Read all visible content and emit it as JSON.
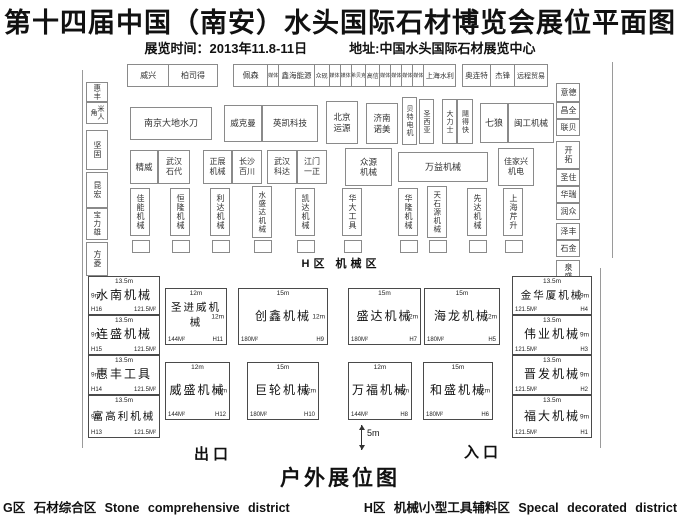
{
  "header": {
    "title": "第十四届中国（南安）水头国际石材博览会展位平面图",
    "time": "展览时间：2013年11.8-11日",
    "address": "地址:中国水头国际石材展览中心"
  },
  "plan": {
    "hall_label": "H区 机械区",
    "top_row": [
      {
        "label": "威兴",
        "w": 44,
        "fs": 8
      },
      {
        "label": "柏司得",
        "w": 52,
        "fs": 8
      },
      {
        "gap": true,
        "w": 18
      },
      {
        "label": "佩森",
        "w": 36,
        "fs": 8
      },
      {
        "label": "媒体",
        "w": 11,
        "fs": 5
      },
      {
        "label": "鑫海能源",
        "w": 38,
        "fs": 7.5
      },
      {
        "label": "众砚",
        "w": 15,
        "fs": 6
      },
      {
        "label": "媒体",
        "w": 11,
        "fs": 5
      },
      {
        "label": "媒体",
        "w": 11,
        "fs": 5
      },
      {
        "label": "希贝克",
        "w": 15,
        "fs": 5
      },
      {
        "label": "高信",
        "w": 14,
        "fs": 6
      },
      {
        "label": "媒体",
        "w": 11,
        "fs": 5
      },
      {
        "label": "媒体",
        "w": 11,
        "fs": 5
      },
      {
        "label": "媒体",
        "w": 11,
        "fs": 5
      },
      {
        "label": "媒体",
        "w": 11,
        "fs": 5
      },
      {
        "label": "上海水利",
        "w": 34,
        "fs": 7
      },
      {
        "gap": true,
        "w": 7
      },
      {
        "label": "奥连特",
        "w": 30,
        "fs": 7.5
      },
      {
        "label": "杰锋",
        "w": 25,
        "fs": 7.5
      },
      {
        "label": "远程贸易",
        "w": 35,
        "fs": 7
      }
    ],
    "hall_booths": [
      {
        "label": "惠丰",
        "x": 86,
        "y": 82,
        "w": 22,
        "h": 20,
        "v": true,
        "fs": 7.5
      },
      {
        "label": "米人角",
        "x": 86,
        "y": 102,
        "w": 22,
        "h": 22,
        "v": true,
        "fs": 7
      },
      {
        "label": "坚固",
        "x": 86,
        "y": 130,
        "w": 22,
        "h": 40,
        "v": true,
        "fs": 8
      },
      {
        "label": "昆宏",
        "x": 86,
        "y": 172,
        "w": 22,
        "h": 36,
        "v": true,
        "fs": 8
      },
      {
        "label": "宝力雄",
        "x": 86,
        "y": 208,
        "w": 22,
        "h": 32,
        "v": true,
        "fs": 7.5
      },
      {
        "label": "方菱",
        "x": 86,
        "y": 242,
        "w": 22,
        "h": 34,
        "v": true,
        "fs": 8
      },
      {
        "label": "德意",
        "x": 556,
        "y": 83,
        "w": 24,
        "h": 19,
        "v": true,
        "fs": 8
      },
      {
        "label": "全昌",
        "x": 556,
        "y": 102,
        "w": 24,
        "h": 17,
        "v": true,
        "fs": 8
      },
      {
        "label": "贝联",
        "x": 556,
        "y": 119,
        "w": 24,
        "h": 17,
        "v": true,
        "fs": 8
      },
      {
        "label": "开拓",
        "x": 556,
        "y": 141,
        "w": 24,
        "h": 28,
        "v": true,
        "fs": 8
      },
      {
        "label": "住圣",
        "x": 556,
        "y": 169,
        "w": 24,
        "h": 17,
        "v": true,
        "fs": 8
      },
      {
        "label": "瑞华",
        "x": 556,
        "y": 186,
        "w": 24,
        "h": 17,
        "v": true,
        "fs": 8
      },
      {
        "label": "众润",
        "x": 556,
        "y": 203,
        "w": 24,
        "h": 17,
        "v": true,
        "fs": 8
      },
      {
        "label": "丰泽",
        "x": 556,
        "y": 223,
        "w": 24,
        "h": 17,
        "v": true,
        "fs": 8
      },
      {
        "label": "金石",
        "x": 556,
        "y": 240,
        "w": 24,
        "h": 17,
        "v": true,
        "fs": 8
      },
      {
        "label": "泉盛",
        "x": 556,
        "y": 260,
        "w": 24,
        "h": 24,
        "v": true,
        "fs": 8
      },
      {
        "label": "南京大地水刀",
        "x": 130,
        "y": 107,
        "w": 82,
        "h": 33,
        "fs": 9
      },
      {
        "label": "威克曼",
        "x": 224,
        "y": 105,
        "w": 38,
        "h": 37,
        "fs": 8.5
      },
      {
        "label": "英凯科技",
        "x": 262,
        "y": 105,
        "w": 56,
        "h": 37,
        "fs": 8.5
      },
      {
        "label": "北京\n运源",
        "x": 326,
        "y": 101,
        "w": 32,
        "h": 43,
        "fs": 8.5
      },
      {
        "label": "济南\n诺美",
        "x": 366,
        "y": 103,
        "w": 32,
        "h": 41,
        "fs": 8.5
      },
      {
        "label": "贝特电机",
        "x": 402,
        "y": 97,
        "w": 15,
        "h": 48,
        "v": true,
        "fs": 7
      },
      {
        "label": "圣西亚",
        "x": 419,
        "y": 99,
        "w": 15,
        "h": 45,
        "v": true,
        "fs": 7
      },
      {
        "label": "大力士",
        "x": 442,
        "y": 99,
        "w": 15,
        "h": 45,
        "v": true,
        "fs": 7
      },
      {
        "label": "飓得快",
        "x": 457,
        "y": 99,
        "w": 16,
        "h": 45,
        "v": true,
        "fs": 7
      },
      {
        "label": "七狼",
        "x": 480,
        "y": 103,
        "w": 28,
        "h": 40,
        "fs": 9
      },
      {
        "label": "闽工机械",
        "x": 508,
        "y": 103,
        "w": 46,
        "h": 40,
        "fs": 8.5
      },
      {
        "label": "精威",
        "x": 130,
        "y": 150,
        "w": 28,
        "h": 34,
        "fs": 8.5
      },
      {
        "label": "武汉\n石代",
        "x": 158,
        "y": 150,
        "w": 32,
        "h": 34,
        "fs": 8
      },
      {
        "label": "正展\n机械",
        "x": 203,
        "y": 150,
        "w": 29,
        "h": 34,
        "fs": 8
      },
      {
        "label": "长沙\n百川",
        "x": 232,
        "y": 150,
        "w": 30,
        "h": 34,
        "fs": 8
      },
      {
        "label": "武汉\n科达",
        "x": 267,
        "y": 150,
        "w": 30,
        "h": 34,
        "fs": 8
      },
      {
        "label": "江门\n一正",
        "x": 297,
        "y": 150,
        "w": 30,
        "h": 34,
        "fs": 8
      },
      {
        "label": "众源\n机械",
        "x": 345,
        "y": 148,
        "w": 47,
        "h": 38,
        "fs": 8.5
      },
      {
        "label": "万益机械",
        "x": 398,
        "y": 152,
        "w": 90,
        "h": 30,
        "fs": 9
      },
      {
        "label": "佳家兴\n机电",
        "x": 498,
        "y": 148,
        "w": 36,
        "h": 38,
        "fs": 8
      },
      {
        "label": "佳能机械",
        "x": 130,
        "y": 188,
        "w": 20,
        "h": 48,
        "v": true,
        "fs": 8
      },
      {
        "label": "恒隆机械",
        "x": 170,
        "y": 188,
        "w": 20,
        "h": 48,
        "v": true,
        "fs": 8
      },
      {
        "label": "利达机械",
        "x": 210,
        "y": 188,
        "w": 20,
        "h": 48,
        "v": true,
        "fs": 8
      },
      {
        "label": "水盛达机械",
        "x": 252,
        "y": 186,
        "w": 20,
        "h": 52,
        "v": true,
        "fs": 7.5
      },
      {
        "label": "凯达机械",
        "x": 295,
        "y": 188,
        "w": 20,
        "h": 48,
        "v": true,
        "fs": 8
      },
      {
        "label": "华大工具",
        "x": 342,
        "y": 188,
        "w": 20,
        "h": 48,
        "v": true,
        "fs": 8
      },
      {
        "label": "华隆机械",
        "x": 398,
        "y": 188,
        "w": 20,
        "h": 48,
        "v": true,
        "fs": 8
      },
      {
        "label": "天石源机械",
        "x": 427,
        "y": 186,
        "w": 20,
        "h": 52,
        "v": true,
        "fs": 7.5
      },
      {
        "label": "先达机械",
        "x": 467,
        "y": 188,
        "w": 20,
        "h": 48,
        "v": true,
        "fs": 8
      },
      {
        "label": "上海芹升",
        "x": 503,
        "y": 188,
        "w": 20,
        "h": 48,
        "v": true,
        "fs": 8
      },
      {
        "label": "",
        "x": 132,
        "y": 240,
        "w": 18,
        "h": 13
      },
      {
        "label": "",
        "x": 172,
        "y": 240,
        "w": 18,
        "h": 13
      },
      {
        "label": "",
        "x": 212,
        "y": 240,
        "w": 18,
        "h": 13
      },
      {
        "label": "",
        "x": 254,
        "y": 240,
        "w": 18,
        "h": 13
      },
      {
        "label": "",
        "x": 297,
        "y": 240,
        "w": 18,
        "h": 13
      },
      {
        "label": "",
        "x": 344,
        "y": 240,
        "w": 18,
        "h": 13
      },
      {
        "label": "",
        "x": 400,
        "y": 240,
        "w": 18,
        "h": 13
      },
      {
        "label": "",
        "x": 429,
        "y": 240,
        "w": 18,
        "h": 13
      },
      {
        "label": "",
        "x": 469,
        "y": 240,
        "w": 18,
        "h": 13
      },
      {
        "label": "",
        "x": 505,
        "y": 240,
        "w": 18,
        "h": 13
      }
    ],
    "outdoor": {
      "exit": "出口",
      "entrance": "入口",
      "gap_label": "5m",
      "booths": [
        {
          "name": "水南机械",
          "code": "H16",
          "area": "121.5M²",
          "td": "13.5m",
          "sd": "9m",
          "side": "left",
          "x": 88,
          "y": 276,
          "w": 72,
          "h": 39
        },
        {
          "name": "连盛机械",
          "code": "H15",
          "area": "121.5M²",
          "td": "13.5m",
          "sd": "9m",
          "side": "left",
          "x": 88,
          "y": 315,
          "w": 72,
          "h": 40
        },
        {
          "name": "惠丰工具",
          "code": "H14",
          "area": "121.5M²",
          "td": "13.5m",
          "sd": "9m",
          "side": "left",
          "x": 88,
          "y": 355,
          "w": 72,
          "h": 40
        },
        {
          "name": "富高利机械",
          "code": "H13",
          "area": "121.5M²",
          "td": "13.5m",
          "sd": "9m",
          "side": "left",
          "x": 88,
          "y": 395,
          "w": 72,
          "h": 43
        },
        {
          "name": "圣进威机械",
          "code": "H11",
          "area": "144M²",
          "td": "12m",
          "sd": "12m",
          "side": "right",
          "x": 165,
          "y": 288,
          "w": 62,
          "h": 57
        },
        {
          "name": "创鑫机械",
          "code": "H9",
          "area": "180M²",
          "td": "15m",
          "sd": "12m",
          "side": "right",
          "x": 238,
          "y": 288,
          "w": 90,
          "h": 57
        },
        {
          "name": "盛达机械",
          "code": "H7",
          "area": "180M²",
          "td": "15m",
          "sd": "12m",
          "side": "right",
          "x": 348,
          "y": 288,
          "w": 73,
          "h": 57
        },
        {
          "name": "海龙机械",
          "code": "H5",
          "area": "180M²",
          "td": "15m",
          "sd": "12m",
          "side": "right",
          "x": 424,
          "y": 288,
          "w": 76,
          "h": 57
        },
        {
          "name": "威盛机械",
          "code": "H12",
          "area": "144M²",
          "td": "12m",
          "sd": "12m",
          "side": "right",
          "x": 165,
          "y": 362,
          "w": 65,
          "h": 58
        },
        {
          "name": "巨轮机械",
          "code": "H10",
          "area": "180M²",
          "td": "15m",
          "sd": "12m",
          "side": "right",
          "x": 247,
          "y": 362,
          "w": 72,
          "h": 58
        },
        {
          "name": "万福机械",
          "code": "H8",
          "area": "144M²",
          "td": "12m",
          "sd": "12m",
          "side": "right",
          "x": 348,
          "y": 362,
          "w": 64,
          "h": 58
        },
        {
          "name": "和盛机械",
          "code": "H6",
          "area": "180M²",
          "td": "15m",
          "sd": "12m",
          "side": "right",
          "x": 423,
          "y": 362,
          "w": 70,
          "h": 58
        },
        {
          "name": "金华厦机械",
          "code": "H4",
          "area": "121.5M²",
          "td": "13.5m",
          "sd": "9m",
          "side": "right",
          "x": 512,
          "y": 276,
          "w": 80,
          "h": 39
        },
        {
          "name": "伟业机械",
          "code": "H3",
          "area": "121.5M²",
          "td": "13.5m",
          "sd": "9m",
          "side": "right",
          "x": 512,
          "y": 315,
          "w": 80,
          "h": 40
        },
        {
          "name": "晋发机械",
          "code": "H2",
          "area": "121.5M²",
          "td": "13.5m",
          "sd": "9m",
          "side": "right",
          "x": 512,
          "y": 355,
          "w": 80,
          "h": 40
        },
        {
          "name": "福大机械",
          "code": "H1",
          "area": "121.5M²",
          "td": "13.5m",
          "sd": "9m",
          "side": "right",
          "x": 512,
          "y": 395,
          "w": 80,
          "h": 43
        }
      ]
    }
  },
  "outdoor_title": "户外展位图",
  "legend": {
    "g": "G区 石材综合区 Stone comprehensive district",
    "h": "H区 机械\\小型工具辅料区 Specal decorated district"
  }
}
